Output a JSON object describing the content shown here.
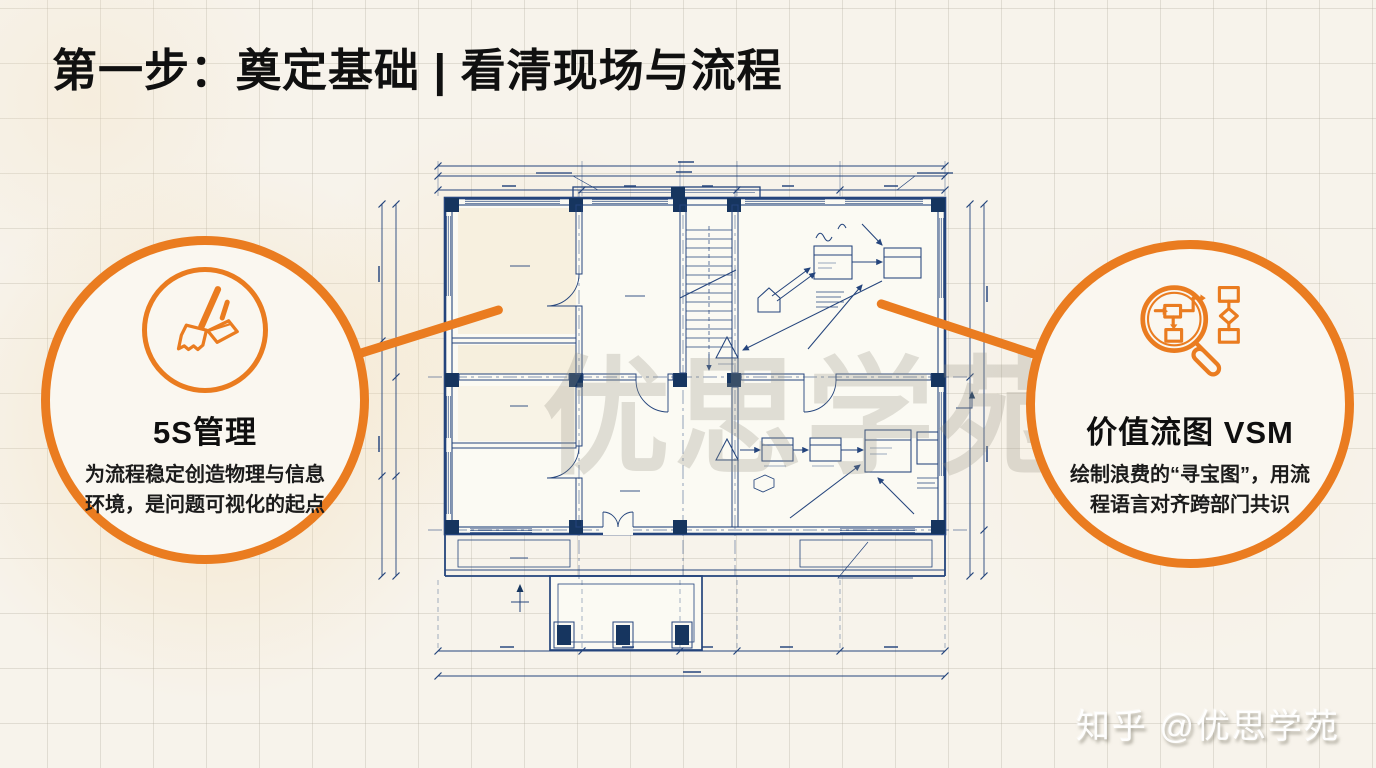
{
  "colors": {
    "accent_orange": "#EA7C20",
    "blueprint_navy": "#24447C",
    "blueprint_column_navy": "#16355F",
    "background_cream": "#F7F3EB",
    "room_beige": "#F3E6CB",
    "title_black": "#101010"
  },
  "header": {
    "title": "第一步：奠定基础 | 看清现场与流程"
  },
  "cards": [
    {
      "icon": "broom-dustpan",
      "heading": "5S管理",
      "desc_line1": "为流程稳定创造物理与信息",
      "desc_line2": "环境，是问题可视化的起点"
    },
    {
      "icon": "magnifier-flowchart",
      "heading": "价值流图 VSM",
      "desc_line1": "绘制浪费的“寻宝图”，用流",
      "desc_line2": "程语言对齐跨部门共识"
    }
  ],
  "blueprint": {
    "center_watermark": "优思学苑"
  },
  "footer": {
    "brand_watermark": "知乎 @优思学苑"
  }
}
